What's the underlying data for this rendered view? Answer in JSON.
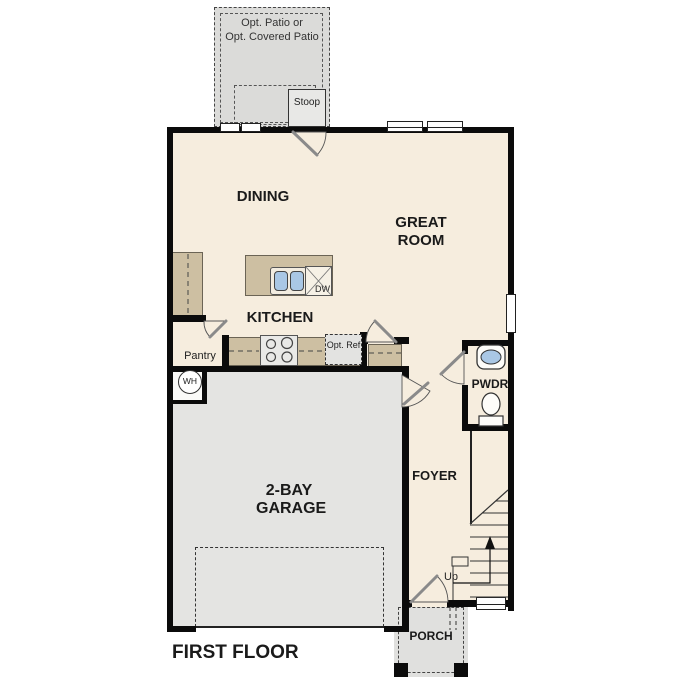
{
  "plan": {
    "title": "FIRST FLOOR",
    "rooms": {
      "patio_line1": "Opt. Patio or",
      "patio_line2": "Opt. Covered Patio",
      "stoop": "Stoop",
      "dining": "DINING",
      "great_room": "GREAT ROOM",
      "kitchen": "KITCHEN",
      "pantry": "Pantry",
      "garage": "2-BAY GARAGE",
      "foyer": "FOYER",
      "pwdr": "PWDR",
      "porch": "PORCH"
    },
    "fixtures": {
      "dishwasher": "DW",
      "opt_ref": "Opt. Ref",
      "water_heater": "WH",
      "stairs_up": "Up"
    },
    "colors": {
      "floor_cream": "#f6edde",
      "garage_gray": "#e4e4e2",
      "patio_gray": "#dbdbd9",
      "cabinet_tan": "#cdbfa2",
      "sink_blue": "#a9c7e5",
      "wall_black": "#0b0b0b"
    }
  }
}
